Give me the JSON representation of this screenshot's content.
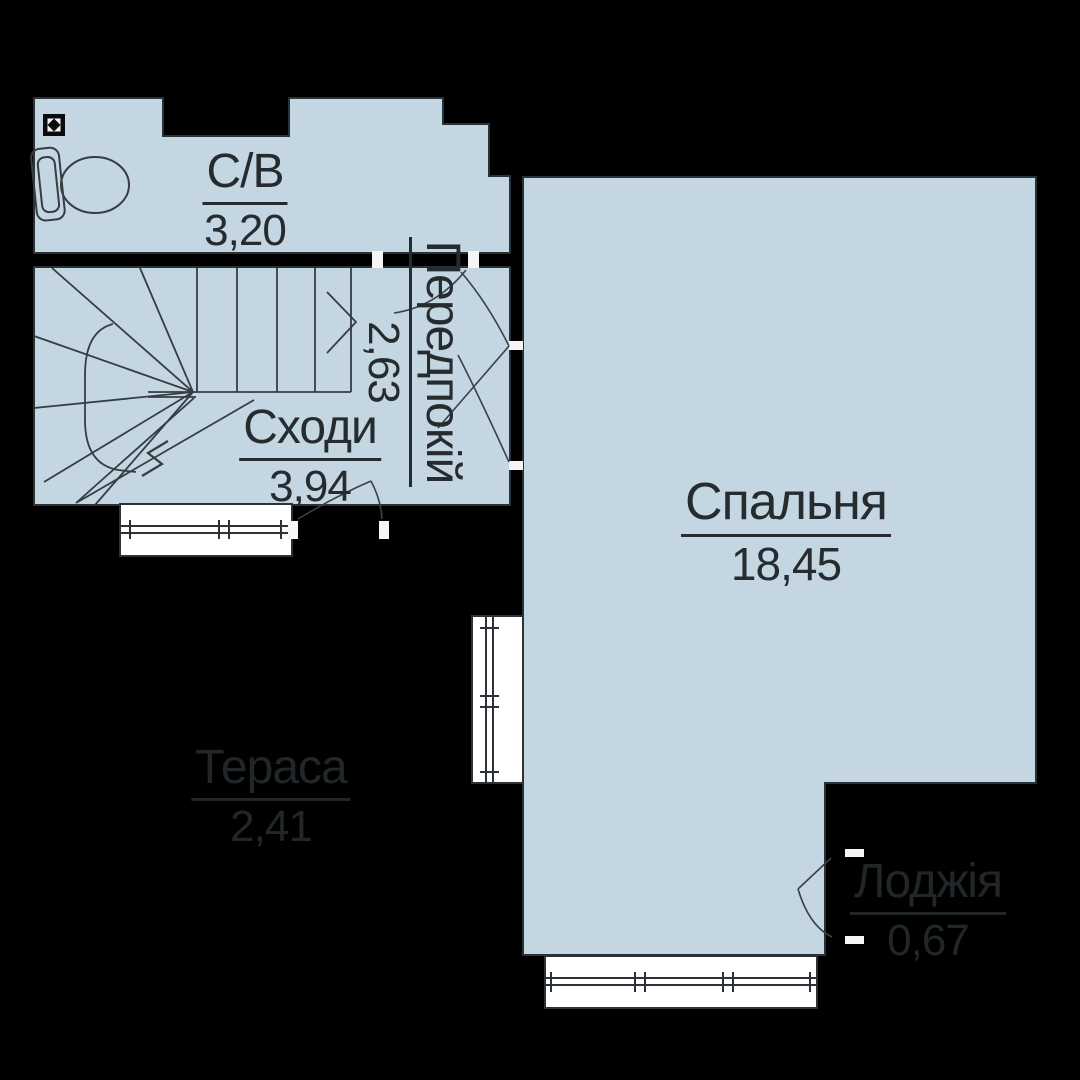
{
  "plan": {
    "background_color": "#000000",
    "room_fill_color": "#c3d6e1",
    "drawing_line_color": "#363c42",
    "window_fill_color": "#ffffff",
    "label_color": "#262b2f",
    "faint_label_color": "#212629",
    "rooms": [
      {
        "id": "bathroom",
        "name": "С/В",
        "area": "3,20"
      },
      {
        "id": "stairs",
        "name": "Сходи",
        "area": "3,94"
      },
      {
        "id": "hallway",
        "name": "Передпокій",
        "area": "2,63"
      },
      {
        "id": "bedroom",
        "name": "Спальня",
        "area": "18,45"
      },
      {
        "id": "terrace",
        "name": "Тераса",
        "area": "2,41"
      },
      {
        "id": "loggia",
        "name": "Лоджія",
        "area": "0,67"
      }
    ]
  }
}
